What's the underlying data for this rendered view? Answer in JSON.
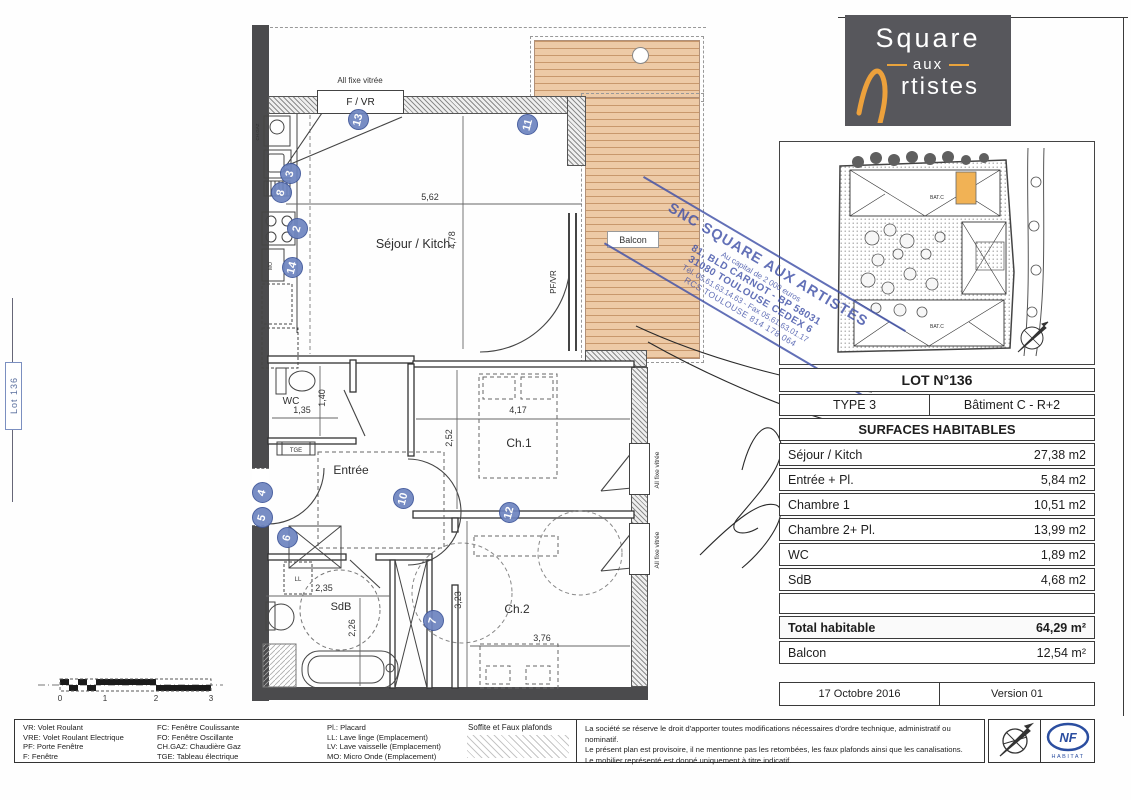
{
  "logo": {
    "word1": "Square",
    "word2": "aux",
    "word3": "rtistes"
  },
  "side_label": "Lot 136",
  "plan": {
    "rooms": {
      "sejour": "Séjour / Kitch",
      "balcon": "Balcon",
      "wc": "WC",
      "entree": "Entrée",
      "ch1": "Ch.1",
      "ch2": "Ch.2",
      "sdb": "SdB"
    },
    "dims": {
      "sejour_w": "5,62",
      "sejour_h": "4,78",
      "wc_h": "1,40",
      "wc_w": "1,35",
      "ch1_w": "4,17",
      "ch1_h": "2,52",
      "sdb_w": "2,35",
      "sdb_h": "2,26",
      "ch2_h": "3,23",
      "ch2_w": "3,76"
    },
    "labels": {
      "fixe": "All fixe vitrée",
      "fvr_top": "F / VR",
      "pfvr": "PF/VR",
      "fvr": "F / VR"
    },
    "fixtures": {
      "chgaz": "CH.GAZ",
      "tge": "TGE",
      "ll": "LL",
      "mo": "MO"
    },
    "markers": [
      "13",
      "11",
      "3",
      "8",
      "2",
      "14",
      "4",
      "5",
      "6",
      "10",
      "12",
      "7"
    ]
  },
  "site_plan": {
    "bat_top": "BAT.C",
    "bat_bottom": "BAT.C"
  },
  "stamp": {
    "lines": [
      "SNC SQUARE AUX ARTISTES",
      "Au capital de 2 000 euros",
      "81, BLD CARNOT - BP 58031",
      "31080 TOULOUSE CEDEX 6",
      "Tél. 05.61.63.14.63 - Fax 05.61.63.01.17",
      "RCS TOULOUSE 814 178 064"
    ]
  },
  "table": {
    "lot_title": "LOT N°136",
    "type": "TYPE 3",
    "building": "Bâtiment C - R+2",
    "section_title": "SURFACES HABITABLES",
    "rows": [
      {
        "label": "Séjour / Kitch",
        "value": "27,38 m2"
      },
      {
        "label": "Entrée + Pl.",
        "value": "5,84 m2"
      },
      {
        "label": "Chambre 1",
        "value": "10,51 m2"
      },
      {
        "label": "Chambre 2+ Pl.",
        "value": "13,99 m2"
      },
      {
        "label": "WC",
        "value": "1,89 m2"
      },
      {
        "label": "SdB",
        "value": "4,68 m2"
      }
    ],
    "total_label": "Total habitable",
    "total_value": "64,29 m²",
    "balcony_label": "Balcon",
    "balcony_value": "12,54 m²"
  },
  "footer_meta": {
    "date": "17 Octobre 2016",
    "version": "Version 01"
  },
  "legend": {
    "columns": [
      [
        "VR: Volet Roulant",
        "VRE: Volet Roulant Electrique",
        "PF: Porte Fenêtre",
        "F: Fenêtre"
      ],
      [
        "FC: Fenêtre Coulissante",
        "FO: Fenêtre Oscillante",
        "CH.GAZ: Chaudière Gaz",
        "TGE: Tableau électrique"
      ],
      [
        "Pl.: Placard",
        "LL: Lave linge (Emplacement)",
        "LV: Lave vaisselle (Emplacement)",
        "MO: Micro Onde (Emplacement)"
      ]
    ],
    "soffite": "Soffite et Faux plafonds"
  },
  "disclaimer": {
    "lines": [
      "La société se réserve le droit d'apporter toutes modifications nécessaires d'ordre technique, administratif ou nominatif.",
      "Le présent plan est provisoire, il ne mentionne pas les retombées, les faux plafonds ainsi que les canalisations.",
      "Le mobilier représenté est donné uniquement à titre indicatif."
    ]
  },
  "scalebar": {
    "ticks": [
      "0",
      "1",
      "2",
      "3"
    ]
  },
  "nf": {
    "acronym": "NF",
    "sub": "HABITAT"
  }
}
